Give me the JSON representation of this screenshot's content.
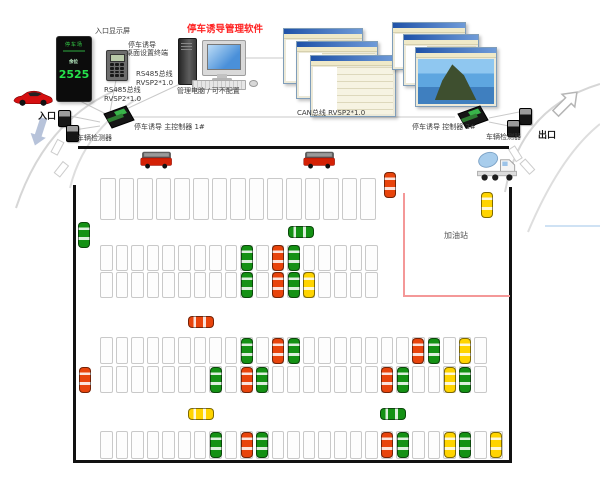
{
  "header": {
    "software_title": "停车诱导管理软件"
  },
  "entry_display": {
    "label": "入口显示屏",
    "screen_name": "停车场",
    "count_prefix": "余位",
    "count": "2525"
  },
  "terminal": {
    "line1": "停车诱导",
    "line2": "桌面设置终端"
  },
  "bus_labels": {
    "rs485_a1": "RS485总线",
    "rs485_a2": "RVSP2*1.0",
    "rs485_b1": "RS485总线",
    "rs485_b2": "RVSP2*1.0",
    "can": "CAN总线 RVSP2*1.0"
  },
  "pc": {
    "label": "管理电脑 / 可不配置"
  },
  "controllers": {
    "main": "停车诱导 主控制器 1#",
    "second": "停车诱导 控制器 2#"
  },
  "detectors": {
    "left": "车辆检测器",
    "right": "车辆检测器"
  },
  "signs": {
    "entrance": "入口",
    "exit": "出口",
    "gas_station": "加油站"
  },
  "colors": {
    "software_title_red": "#ff2222",
    "occupied_red": "#e8440c",
    "car_green": "#149114",
    "car_yellow": "#ffd400",
    "gas_boundary_pink": "#f49898",
    "display_digit_green": "#25e04b"
  },
  "lot": {
    "rows": [
      {
        "id": "row-top-large",
        "x": 100,
        "y": 178,
        "cells": 15,
        "cell_w": 18.6,
        "cell_h": 42,
        "cars": {}
      },
      {
        "id": "row-2a",
        "x": 100,
        "y": 245,
        "cells": 18,
        "cell_w": 15.6,
        "cell_h": 26,
        "cars": {
          "9": "green",
          "11": "red",
          "12": "green"
        }
      },
      {
        "id": "row-2b",
        "x": 100,
        "y": 272,
        "cells": 18,
        "cell_w": 15.6,
        "cell_h": 26,
        "cars": {
          "9": "green",
          "11": "red",
          "12": "green",
          "13": "yellow"
        }
      },
      {
        "id": "row-3a",
        "x": 100,
        "y": 337,
        "cells": 25,
        "cell_w": 15.6,
        "cell_h": 27,
        "cars": {
          "9": "green",
          "11": "red",
          "12": "green",
          "20": "red",
          "21": "green",
          "23": "yellow"
        }
      },
      {
        "id": "row-3b",
        "x": 100,
        "y": 366,
        "cells": 25,
        "cell_w": 15.6,
        "cell_h": 27,
        "cars": {
          "7": "green",
          "9": "red",
          "10": "green",
          "18": "red",
          "19": "green",
          "22": "yellow",
          "23": "green"
        }
      },
      {
        "id": "row-bottom",
        "x": 100,
        "y": 431,
        "cells": 26,
        "cell_w": 15.6,
        "cell_h": 28,
        "cars": {
          "7": "green",
          "9": "red",
          "10": "green",
          "18": "red",
          "19": "green",
          "22": "yellow",
          "23": "green",
          "25": "yellow"
        }
      }
    ],
    "moving_cars": [
      {
        "color": "green",
        "x": 78,
        "y": 222,
        "dir": "v"
      },
      {
        "color": "green",
        "x": 288,
        "y": 226,
        "dir": "h"
      },
      {
        "color": "red",
        "x": 188,
        "y": 316,
        "dir": "h"
      },
      {
        "color": "red",
        "x": 79,
        "y": 367,
        "dir": "v"
      },
      {
        "color": "yellow",
        "x": 188,
        "y": 408,
        "dir": "h"
      },
      {
        "color": "green",
        "x": 380,
        "y": 408,
        "dir": "h"
      },
      {
        "color": "red",
        "x": 384,
        "y": 172,
        "dir": "v"
      },
      {
        "color": "yellow",
        "x": 481,
        "y": 192,
        "dir": "v"
      }
    ]
  }
}
